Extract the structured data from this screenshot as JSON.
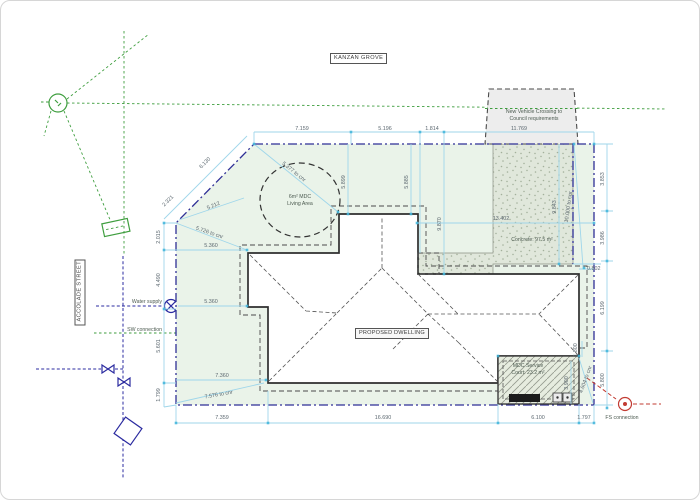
{
  "street_labels": {
    "top": "KANZAN GROVE",
    "left": "ACCOLADE STREET"
  },
  "labels": {
    "dwelling": "PROPOSED DWELLING",
    "vehicle1": "New Vehicle Crossing to",
    "vehicle2": "Council requirements",
    "living1": "6m² MDC",
    "living2": "Living Area",
    "concrete": "Concrete: 97.5 m²",
    "court1": "MDC Service",
    "court2": "Court: 23.2 m²",
    "water": "Water supply",
    "sw": "SW connection",
    "fs": "FS connection"
  },
  "dims": [
    "7.159",
    "5.196",
    "1.814",
    "11.769",
    "6.130",
    "2.321",
    "2.015",
    "4.490",
    "5.601",
    "1.799",
    "7.359",
    "16.690",
    "6.100",
    "1.797",
    "3.853",
    "3.986",
    "6.199",
    "5.800",
    "5.899",
    "5.885",
    "9.870",
    "9.843",
    "13.402",
    "5.360",
    "5.360",
    "7.360",
    "7.576 to cnr",
    "5.726 to cnr",
    "5.212",
    "5.377 to cnr",
    "10.000 to cnr",
    "0.802",
    "1.800",
    "3.900",
    "4.604 to cnr"
  ],
  "colors": {
    "boundary": "#2f2f96",
    "dimension": "#9fd6ea",
    "tick": "#3db4da",
    "green": "#3f9e3f",
    "red": "#c23b32",
    "blue_symbol": "#2b2ba0",
    "site_fill": "#eaf3e9",
    "concrete_fill": "#e0e7db",
    "grey_box": "#ededed"
  }
}
